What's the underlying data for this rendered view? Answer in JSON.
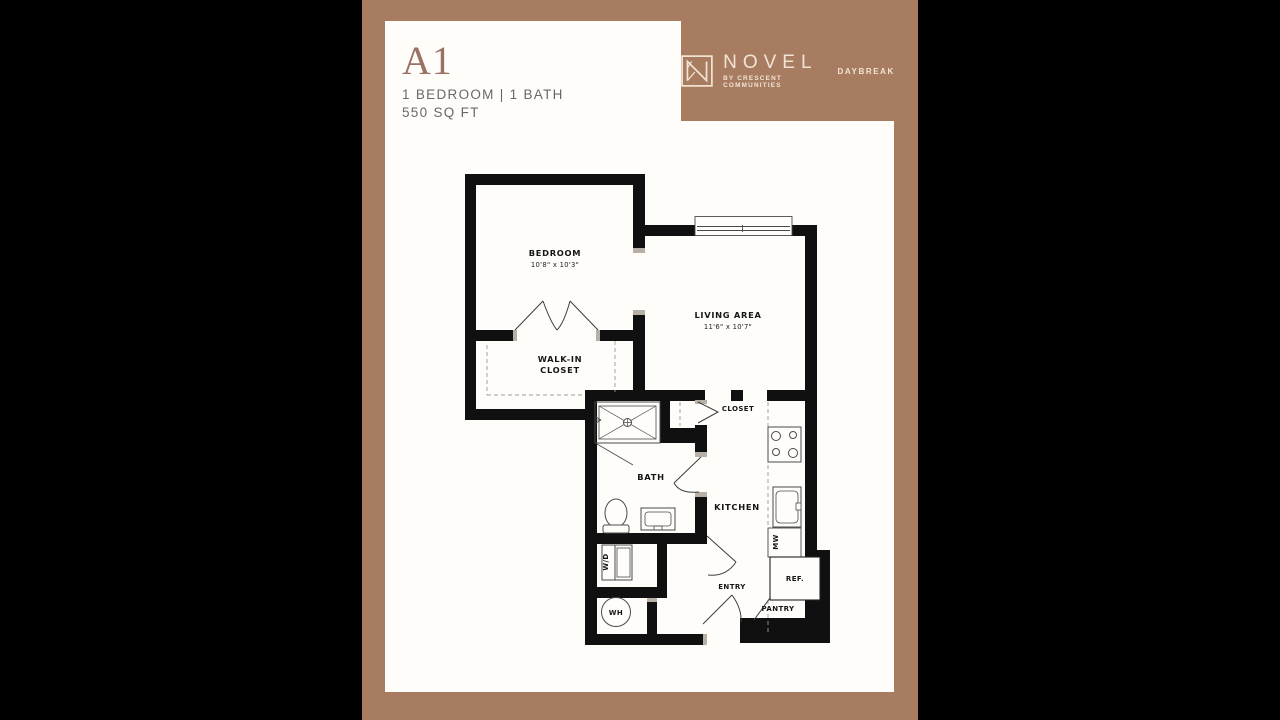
{
  "header": {
    "plan_code": "A1",
    "specs": "1 BEDROOM | 1 BATH",
    "area": "550 SQ FT"
  },
  "brand": {
    "name": "NOVEL",
    "sub": "BY CRESCENT COMMUNITIES",
    "property": "DAYBREAK"
  },
  "colors": {
    "background": "#000000",
    "frame": "#a87c61",
    "page": "#fffdfa",
    "accent": "#9b7164",
    "text_gray": "#686868",
    "logo_cream": "#f2e4d4",
    "wall": "#101010"
  },
  "floorplan": {
    "bedroom_label": "BEDROOM",
    "bedroom_dims": "10'8\" x 10'3\"",
    "living_label": "LIVING AREA",
    "living_dims": "11'6\" x 10'7\"",
    "wic_line1": "WALK-IN",
    "wic_line2": "CLOSET",
    "closet_label": "CLOSET",
    "bath_label": "BATH",
    "kitchen_label": "KITCHEN",
    "entry_label": "ENTRY",
    "pantry_label": "PANTRY",
    "ref_label": "REF.",
    "mw_label": "MW",
    "wd_label": "W/D",
    "wh_label": "WH"
  }
}
